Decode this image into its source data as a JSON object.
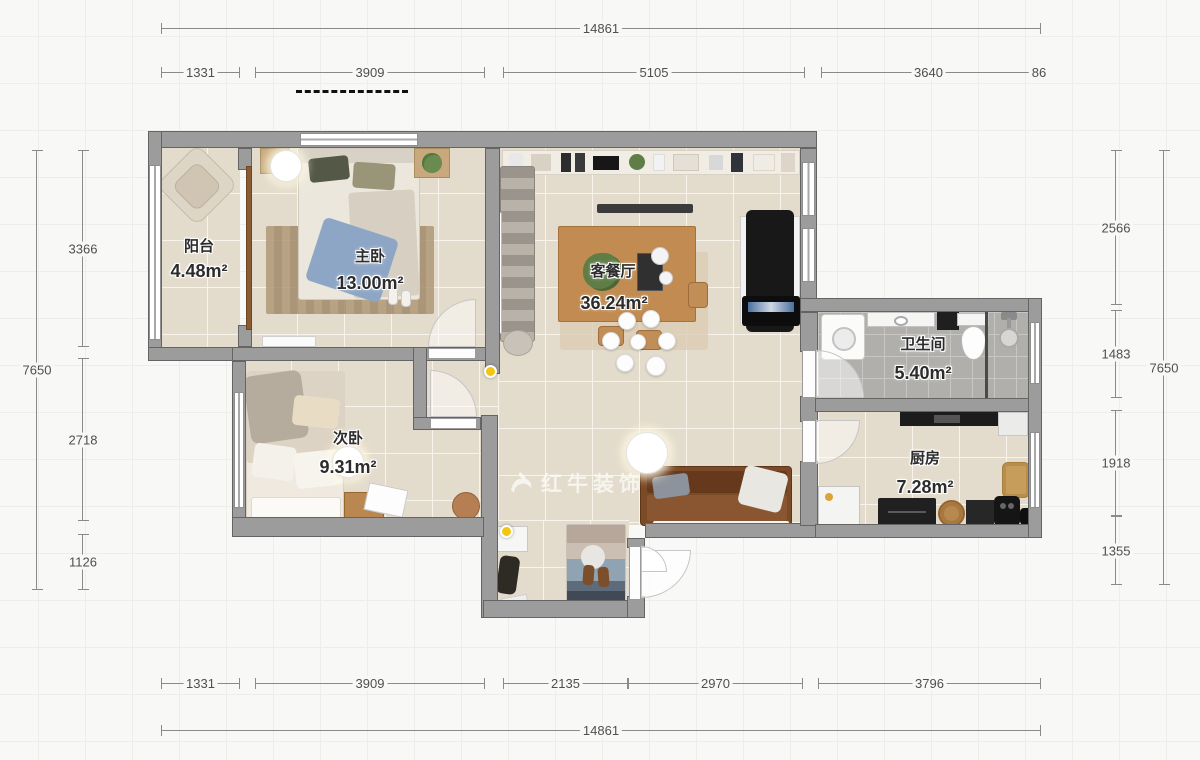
{
  "watermark": {
    "text": "红牛装饰"
  },
  "rooms": {
    "balcony": {
      "name": "阳台",
      "area": "4.48m²"
    },
    "master": {
      "name": "主卧",
      "area": "13.00m²"
    },
    "second": {
      "name": "次卧",
      "area": "9.31m²"
    },
    "living": {
      "name": "客餐厅",
      "area": "36.24m²"
    },
    "bath": {
      "name": "卫生间",
      "area": "5.40m²"
    },
    "kitchen": {
      "name": "厨房",
      "area": "7.28m²"
    }
  },
  "dims": {
    "top_total": "14861",
    "top": [
      "1331",
      "3909",
      "5105",
      "3640",
      "86"
    ],
    "bottom": [
      "1331",
      "3909",
      "2135",
      "2970",
      "3796"
    ],
    "bottom_total": "14861",
    "left_total": "7650",
    "left": [
      "3366",
      "2718",
      "1126"
    ],
    "right": [
      "2566",
      "1483",
      "1918",
      "1355"
    ],
    "right_total": "7650"
  },
  "colors": {
    "wall": "#9c9c9c",
    "floor_tile": "#e3dbcb",
    "bath_tile": "#b0afab",
    "marker": "#f3c614",
    "dim_line": "#8a8a8a"
  }
}
